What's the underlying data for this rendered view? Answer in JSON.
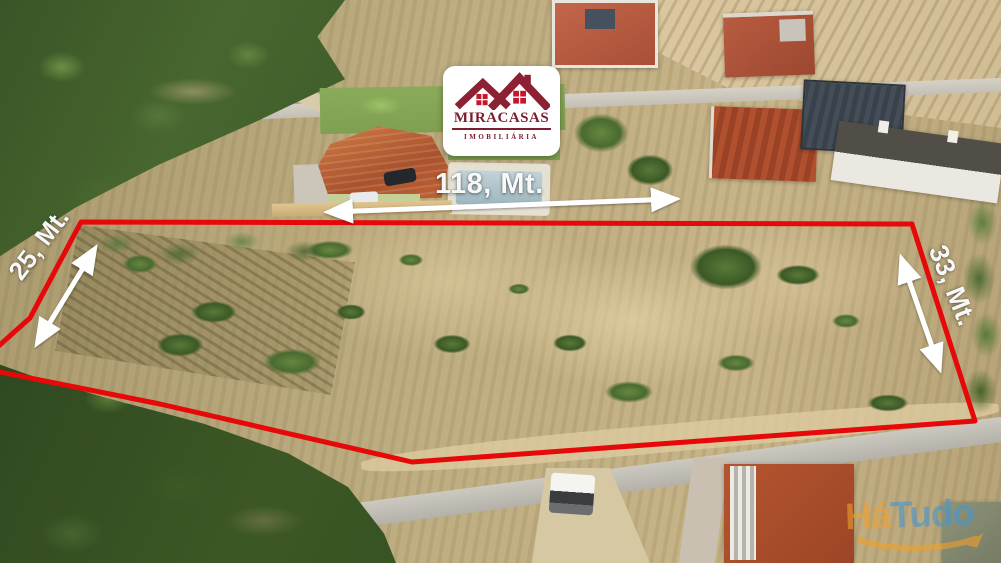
{
  "annotations": {
    "measurements": {
      "top": {
        "label": "118, Mt."
      },
      "left": {
        "label": "25, Mt."
      },
      "right": {
        "label": "33, Mt."
      }
    },
    "boundary_color": "#e60909",
    "arrow_color": "#ffffff"
  },
  "logo": {
    "title": "MIRACASAS",
    "subtitle": "IMOBILIÁRIA",
    "icon": "twin-house-roofs-icon",
    "colors": {
      "roof": "#8c2133",
      "window": "#c3172b",
      "text": "#7c1e2d"
    }
  },
  "watermark": {
    "part1": "Há",
    "part2": "Tudo",
    "icon": "swoosh-arrow-icon",
    "colors": {
      "part1": "#efa02c",
      "part2": "#4596d2"
    }
  }
}
